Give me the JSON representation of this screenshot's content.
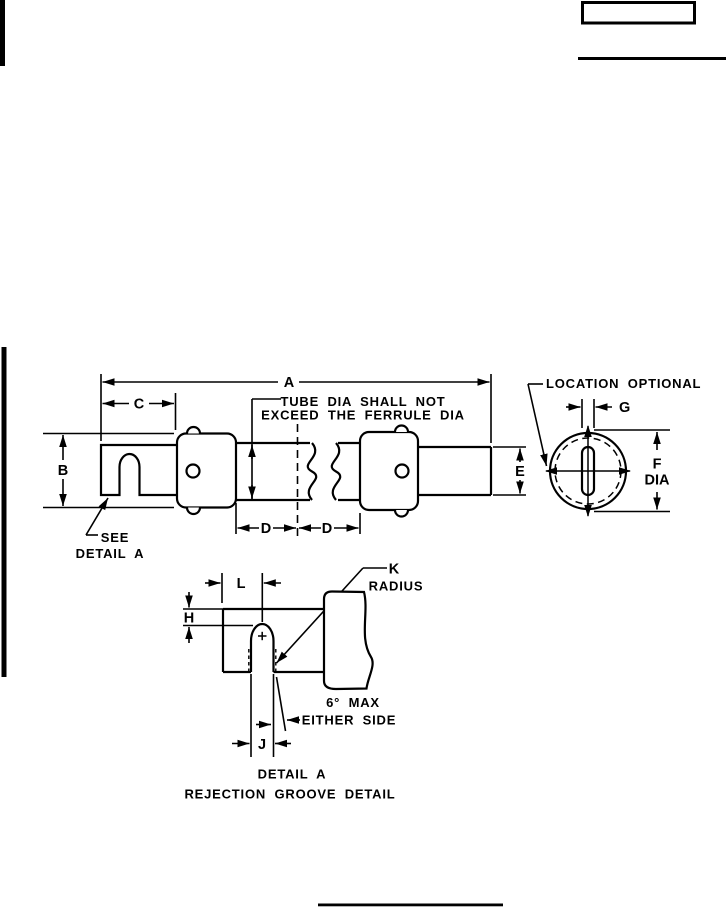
{
  "main_view": {
    "dim_a": "A",
    "dim_b": "B",
    "dim_c": "C",
    "dim_d_left": "D",
    "dim_d_right": "D",
    "dim_e": "E",
    "note_tube_dia": {
      "line1": "TUBE DIA SHALL NOT",
      "line2": "EXCEED THE FERRULE DIA"
    },
    "note_see_detail": {
      "line1": "SEE",
      "line2": "DETAIL A"
    }
  },
  "end_view": {
    "note_location": "LOCATION OPTIONAL",
    "dim_g": "G",
    "dim_f": "F",
    "dim_f_suffix": "DIA"
  },
  "detail_view": {
    "dim_l": "L",
    "dim_h": "H",
    "dim_j": "J",
    "dim_k": "K",
    "dim_k_suffix": "RADIUS",
    "note_taper": {
      "line1": "6° MAX",
      "line2": "EITHER SIDE"
    },
    "caption": "DETAIL A",
    "subcaption": "REJECTION GROOVE DETAIL"
  },
  "colors": {
    "ink": "#000000",
    "paper": "#ffffff"
  }
}
